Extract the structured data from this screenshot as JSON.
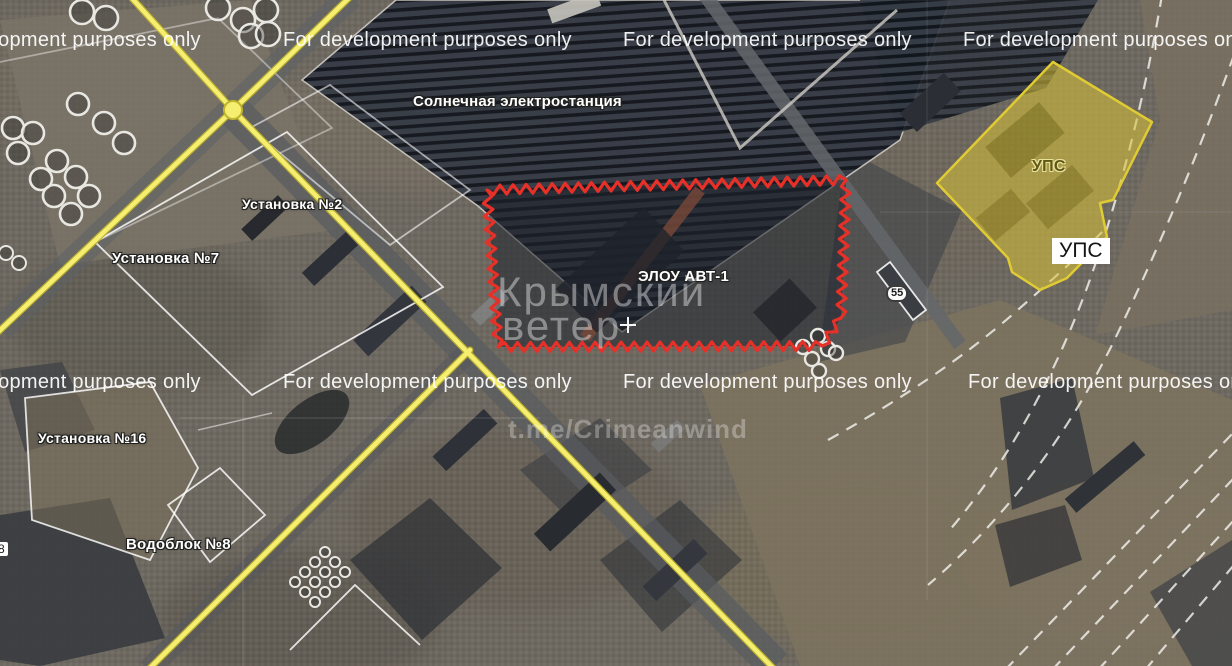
{
  "map": {
    "kind": "satellite-industrial-area",
    "watermarks": {
      "dev": "For development purposes only",
      "brand_line1": "Крымский",
      "brand_line2": "ветер",
      "channel": "t.me/Crimeanwind"
    },
    "labels": {
      "solar_station": "Солнечная электростанция",
      "unit_2": "Установка №2",
      "unit_7": "Установка №7",
      "unit_16": "Установка №16",
      "water_block_8": "Водоблок №8",
      "elou_avt1": "ЭЛОУ АВТ-1",
      "ups_area": "УПС",
      "ups_badge": "УПС",
      "road_shield": "55",
      "edge_partial": "8"
    },
    "marker": {
      "center_cross": "+"
    },
    "colors": {
      "road_yellow": "#f6ee6e",
      "alert_red": "#e63028",
      "ups_fill": "#d8c336",
      "railway_white": "#f5f5f0"
    }
  }
}
